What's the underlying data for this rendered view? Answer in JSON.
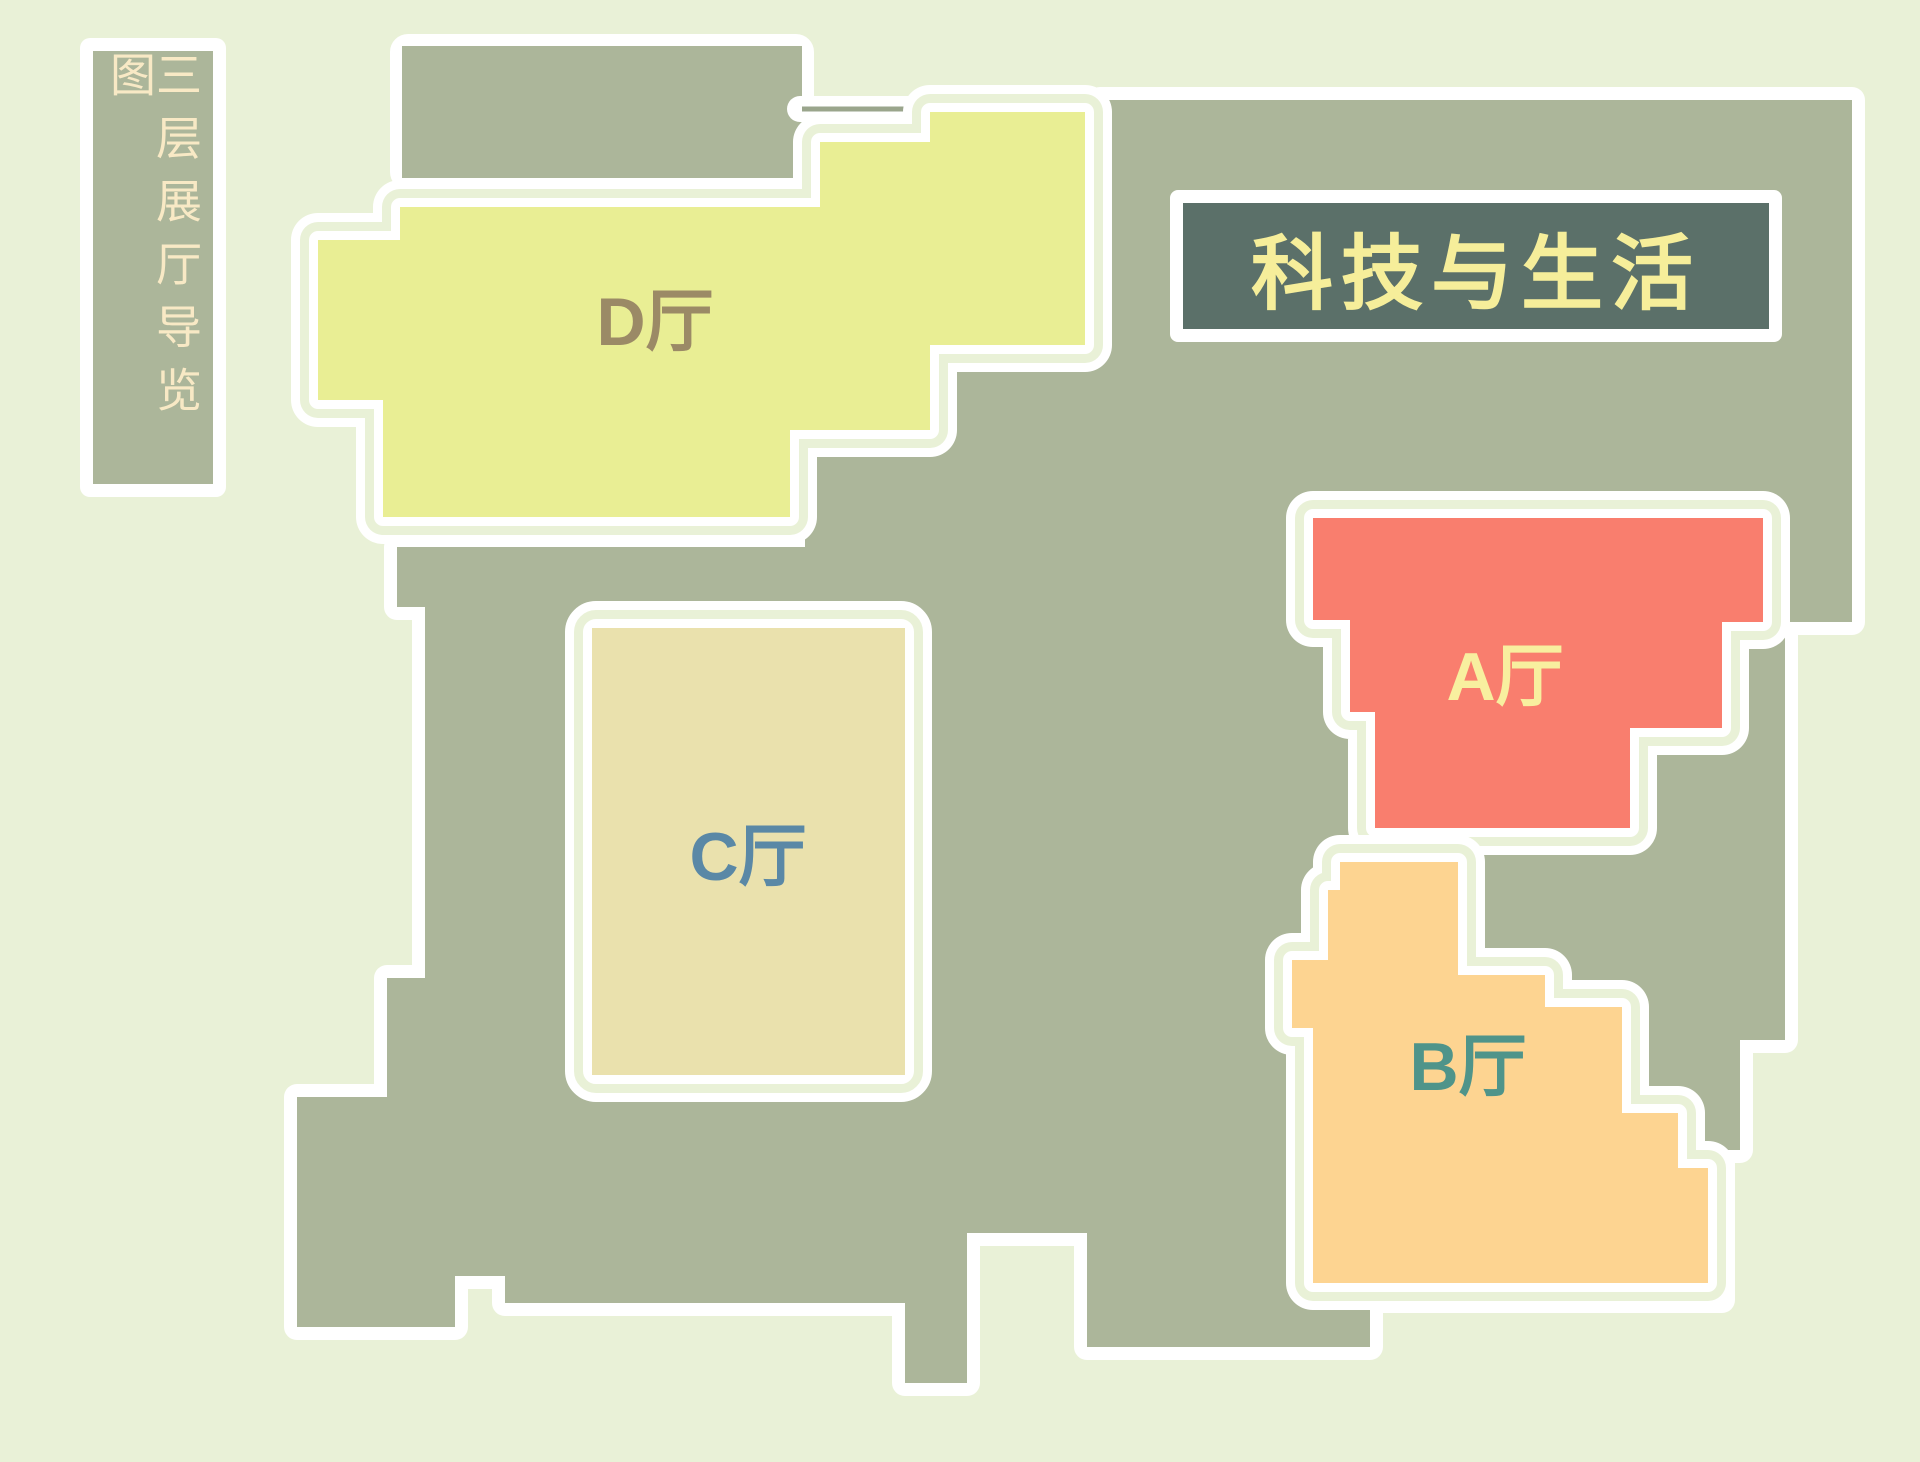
{
  "page_title": "三层展厅导览图",
  "sidebar": {
    "text": "三层展厅导览图"
  },
  "banner": {
    "label": "科技与生活",
    "bg": "#5b7069",
    "text_color": "#f6ee9a"
  },
  "palette": {
    "background": "#e9f1d7",
    "concourse_gray": "#acb69a",
    "border_white": "#ffffff",
    "gap_green": "#e9f1d7",
    "sidebar_text": "#f8e9c5"
  },
  "halls": [
    {
      "id": "D",
      "label": "D厅",
      "color": "#e9ee94",
      "label_color": "#9b8a66"
    },
    {
      "id": "C",
      "label": "C厅",
      "color": "#eae1ad",
      "label_color": "#5a88a6"
    },
    {
      "id": "A",
      "label": "A厅",
      "color": "#f97e6e",
      "label_color": "#f8ef9f"
    },
    {
      "id": "B",
      "label": "B厅",
      "color": "#fdd491",
      "label_color": "#4f948a"
    }
  ]
}
